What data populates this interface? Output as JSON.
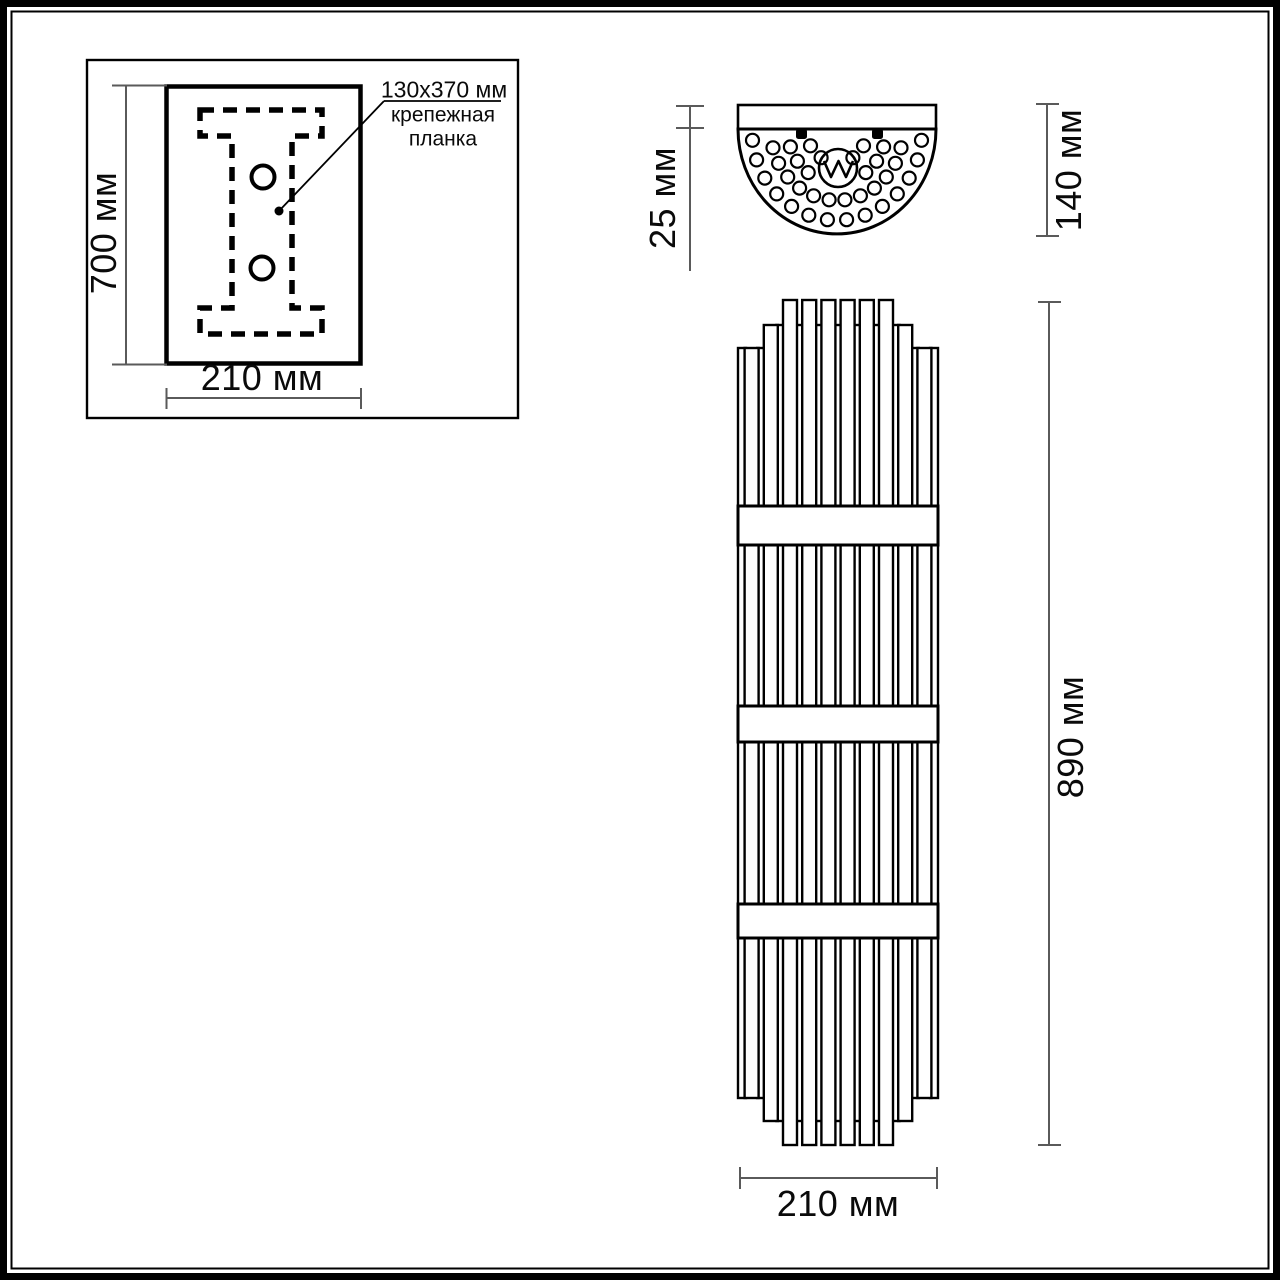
{
  "labels": {
    "inset_plate_size": "130x370 мм",
    "inset_plate_name": "крепежная\nпланка",
    "inset_height": "700 мм",
    "inset_width": "210 мм",
    "top_plate_thickness": "25 мм",
    "top_depth": "140 мм",
    "front_height": "890 мм",
    "front_width": "210 мм"
  },
  "colors": {
    "line": "#000000",
    "dimension_line": "#5a5a5a",
    "background": "#ffffff"
  },
  "geometry": {
    "front_view": {
      "rod_count": 21,
      "first_center_x": 742,
      "rod_step": 9.6,
      "rod_wide_w": 14,
      "rod_narrow_w": 8,
      "rod_top_y": [
        300,
        325,
        348
      ],
      "rod_bottom_y": [
        1145,
        1121,
        1098
      ],
      "wide_tiers": [
        3,
        2,
        1,
        1,
        1,
        1,
        1,
        1,
        2,
        3
      ],
      "narrow_tiers": [
        3,
        3,
        2,
        2,
        2,
        2,
        2,
        2,
        2,
        3,
        3
      ],
      "band_x": 738,
      "band_w": 200,
      "bands": [
        {
          "y": 506,
          "h": 39
        },
        {
          "y": 706,
          "h": 36
        },
        {
          "y": 904,
          "h": 34
        }
      ]
    },
    "top_view": {
      "cx": 837,
      "cy": 131,
      "dot_r": 6.5,
      "y_squash": 1.05,
      "dot_rows": [
        {
          "r": 85,
          "from": 6,
          "to": 174,
          "count": 14
        },
        {
          "r": 66,
          "from": 14,
          "to": 166,
          "count": 12
        },
        {
          "r": 49,
          "from": 18,
          "to": 162,
          "count": 9,
          "skip_from": 70,
          "skip_to": 110
        },
        {
          "r": 30,
          "angles": [
            28,
            58,
            122,
            152
          ]
        }
      ]
    }
  }
}
